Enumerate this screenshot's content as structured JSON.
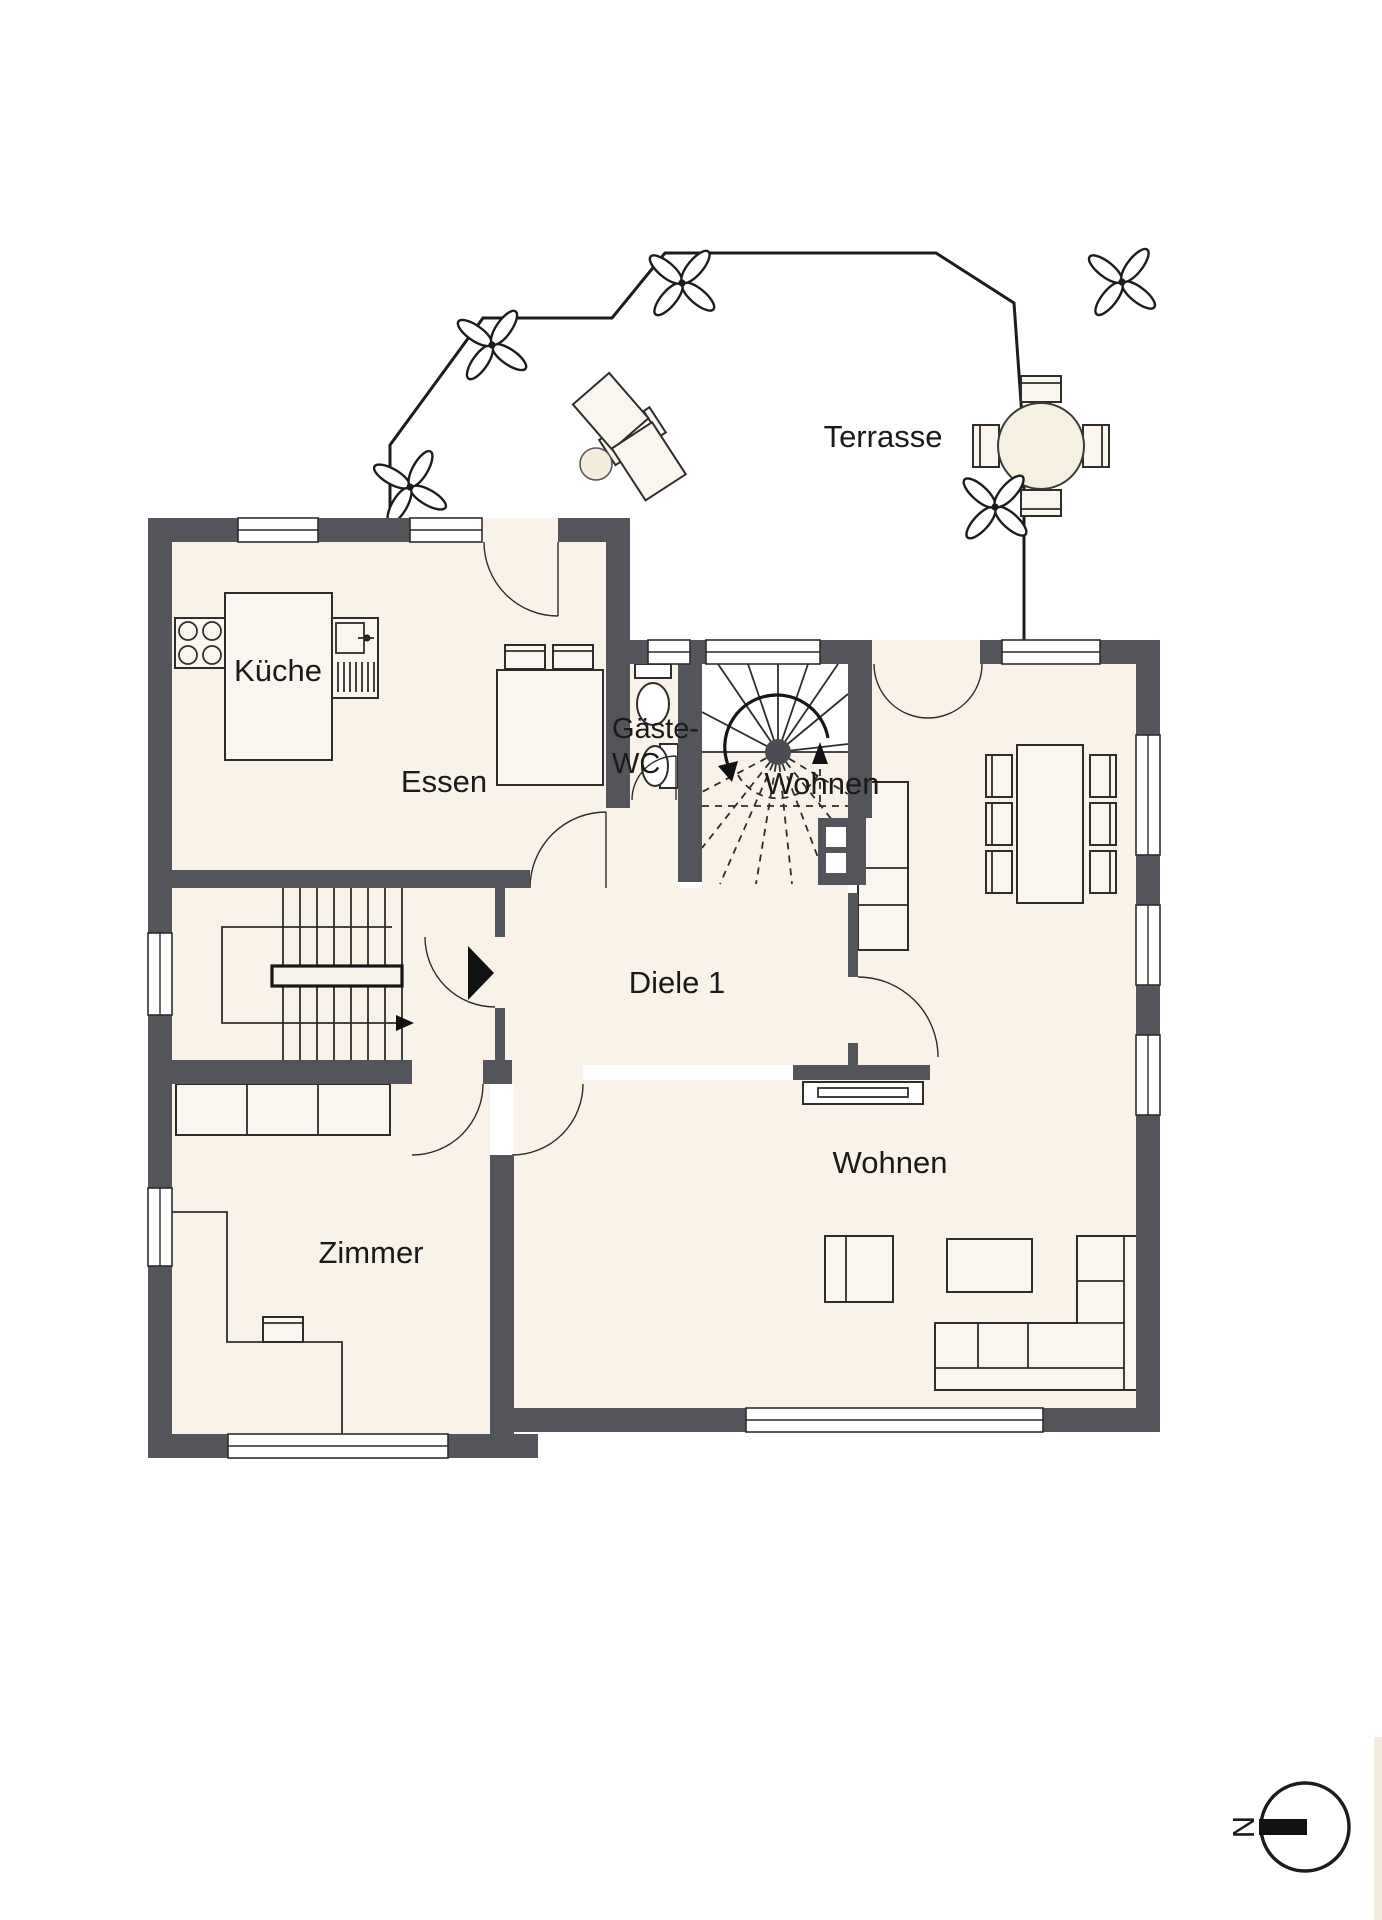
{
  "document": {
    "type": "architectural-floor-plan",
    "floor": "ground-floor"
  },
  "colors": {
    "wall": "#54555b",
    "floor": "#f8f2e8",
    "line": "#2e2d2b",
    "furn": "#faf6ef",
    "page": "#ffffff"
  },
  "labels": {
    "terrace": "Terrasse",
    "kitchen": "Küche",
    "dining": "Essen",
    "guest_wc_line1": "Gäste-",
    "guest_wc_line2": "WC",
    "hall": "Diele 1",
    "living_upper": "Wohnen",
    "living_lower": "Wohnen",
    "room": "Zimmer",
    "compass_north": "N"
  },
  "icons": {
    "plant-icon": "four-petal-flower",
    "north-arrow-icon": "circle-with-bar-N",
    "stair-direction-arrow": "curved-arrow-and-dashed-up-arrow",
    "entrance-marker": "filled-triangle"
  }
}
